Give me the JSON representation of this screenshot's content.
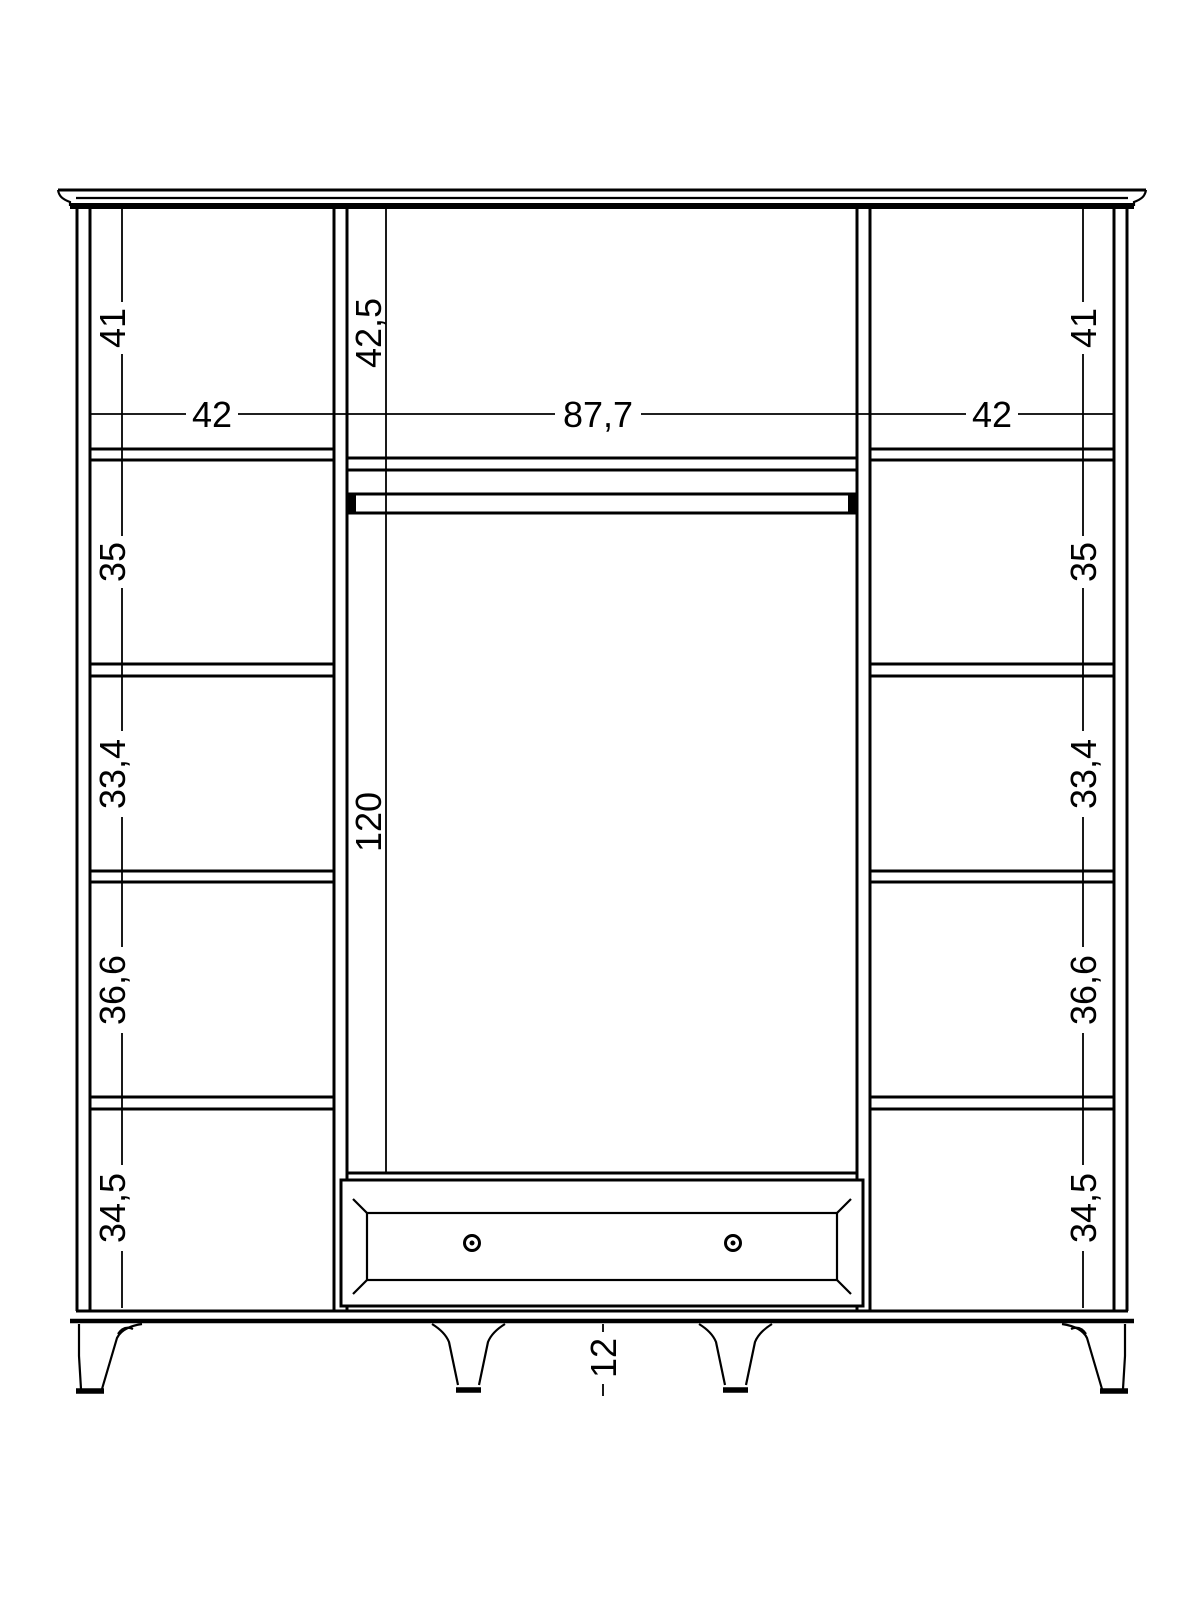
{
  "drawing": {
    "kind": "furniture-technical-drawing",
    "subject": "wardrobe front elevation with shelf columns, hanging section, drawer and legs",
    "units": "cm"
  },
  "colors": {
    "line": "#000000",
    "background": "#ffffff"
  },
  "dimensions": {
    "left_column": {
      "section_heights": [
        "41",
        "35",
        "33,4",
        "36,6",
        "34,5"
      ],
      "width": "42"
    },
    "center_section": {
      "top_compartment_height": "42,5",
      "width": "87,7",
      "hanging_area_height": "120"
    },
    "right_column": {
      "section_heights": [
        "41",
        "35",
        "33,4",
        "36,6",
        "34,5"
      ],
      "width": "42"
    },
    "legs": {
      "height": "12"
    }
  }
}
